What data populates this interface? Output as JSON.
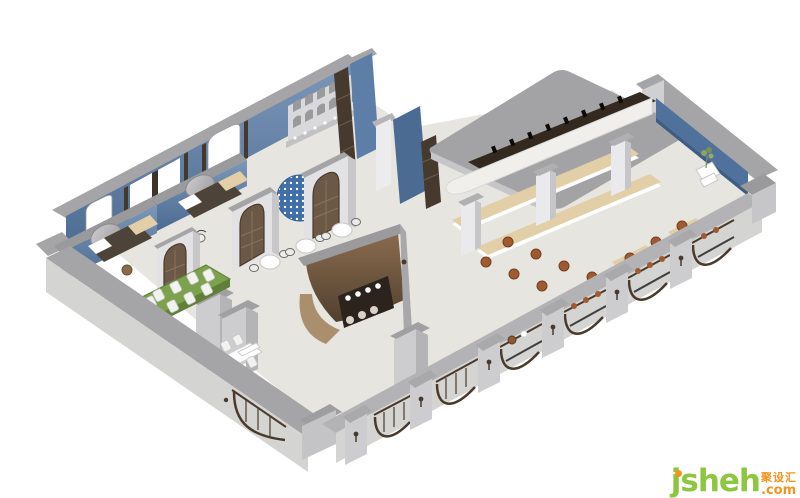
{
  "meta": {
    "type": "3d-axonometric-interior-rendering",
    "subject": "Restaurant and bar interior cutaway floor-plan rendering with blue accent walls, arched bronze-framed facade, private lounge rooms, dining tables and a long curved bar",
    "background": "#ffffff"
  },
  "watermark": {
    "brand": "jsheh",
    "suffix": ".com",
    "cjk": "聚设汇"
  },
  "palette": {
    "floor": "#e7e5e0",
    "wall_cap": "#a5a5a7",
    "wall_cap_dark": "#b3b3b5",
    "wall_face": "#d4d4d2",
    "wall_face_light": "#dddddb",
    "portal_gray": "#c7c7c9",
    "portal_light": "#e2e2e4",
    "blue_wall": "#5d7ea6",
    "blue_wall_dark": "#4c6b92",
    "blue_dome": "#3f6ea8",
    "bronze": "#4a3a2b",
    "wood_door": "#6b5846",
    "wood_dark": "#463a2e",
    "bar_brown": "#7d6248",
    "bar_brown_dark": "#4e3c2d",
    "bar_tan": "#a98f6d",
    "counter_white": "#f0efeb",
    "backbar_dark": "#33291f",
    "bench_beige": "#e2cfa8",
    "green_table": "#7ca24d",
    "green_table_dark": "#5f8038",
    "stool_brown": "#a05a31",
    "mirror_gray": "#b9b9bb",
    "slab_gray": "#a3a3a5",
    "wm_green": "#8dc63f",
    "wm_orange": "#f6921e"
  },
  "scene": {
    "areas": [
      {
        "name": "private-lounge-rooms",
        "items": [
          "blue accent walls",
          "round wall mirrors",
          "daybeds with beige headboards and white pillows",
          "barrel side stool",
          "small round side table",
          "bistro armchair"
        ]
      },
      {
        "name": "dining-area",
        "items": [
          "three round tables with bistro chairs",
          "communal green-top table with eight white chairs",
          "rectangular white table with white chairs and benches",
          "arched glassware display shelf",
          "blue mosaic dome niche",
          "tall gray storage cabinets"
        ]
      },
      {
        "name": "center-coffee-bar",
        "items": [
          "curved walnut enclosure",
          "black service counter with white mugs",
          "white counter stools",
          "gray capped partition band"
        ]
      },
      {
        "name": "main-bar",
        "items": [
          "long curved white bar counter",
          "dark back-bar bottle shelf",
          "gray canopy roof slab",
          "two upholstered benches with beige cushions",
          "three white columns",
          "round leather bar stools",
          "window-side bench cushions",
          "white service cart",
          "potted plant"
        ]
      },
      {
        "name": "facade",
        "items": [
          "arched window bays with bronze frames",
          "glazed arch doors with mullions",
          "gray pilasters with bronze sconces",
          "window counters with stools",
          "thick gray perimeter walls"
        ]
      },
      {
        "name": "structure",
        "items": [
          "three arched walnut door portals",
          "tall blue partition walls",
          "dark shelving strips",
          "white pillar",
          "blue inner face of right wall"
        ]
      }
    ]
  }
}
